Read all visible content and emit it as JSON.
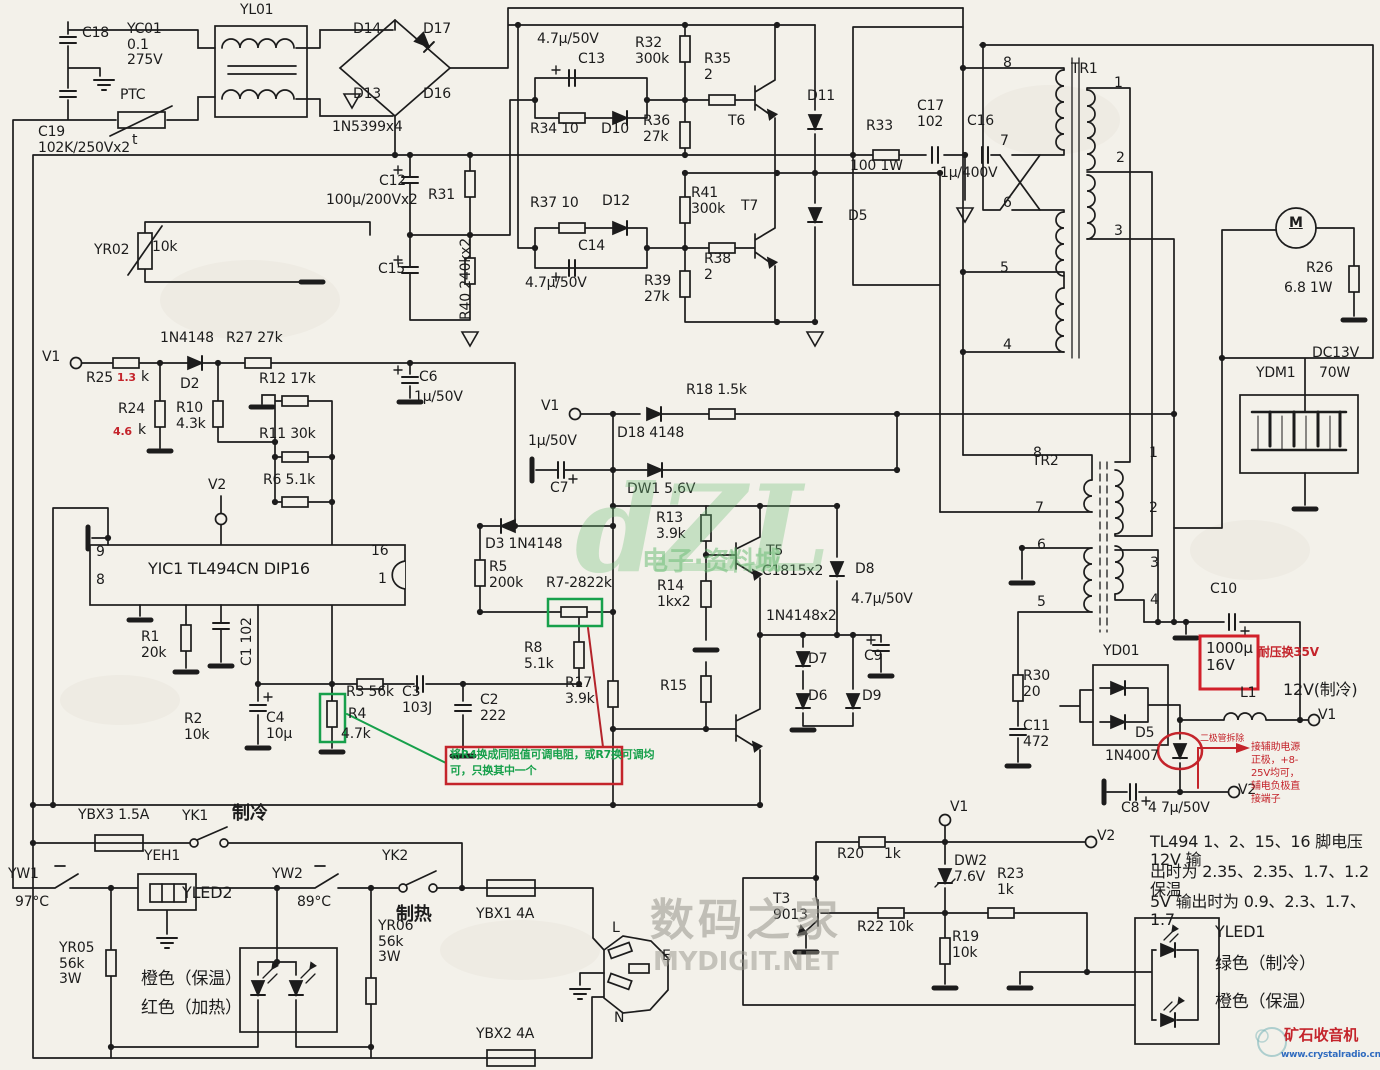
{
  "colors": {
    "paper": "#f3f1ea",
    "ink": "#1c1c1c",
    "red": "#c4242b",
    "green": "#17a04b",
    "blue": "#2f6bbf"
  },
  "labels": [
    {
      "n": "cap-c18",
      "t": "C18",
      "x": 82,
      "y": 26
    },
    {
      "n": "cap-yc01",
      "t": "YC01\n0.1\n275V",
      "x": 127,
      "y": 22
    },
    {
      "n": "ptc",
      "t": "PTC",
      "x": 120,
      "y": 88
    },
    {
      "n": "ptc-t",
      "t": "t",
      "x": 132,
      "y": 133
    },
    {
      "n": "cap-c19",
      "t": "C19\n102K/250Vx2",
      "x": 38,
      "y": 125
    },
    {
      "n": "choke-yl01",
      "t": "YL01",
      "x": 240,
      "y": 3
    },
    {
      "n": "diode-d14",
      "t": "D14",
      "x": 353,
      "y": 22
    },
    {
      "n": "diode-d17",
      "t": "D17",
      "x": 423,
      "y": 22
    },
    {
      "n": "diode-d13",
      "t": "D13",
      "x": 353,
      "y": 87
    },
    {
      "n": "diode-d16",
      "t": "D16",
      "x": 423,
      "y": 87
    },
    {
      "n": "bridge-type",
      "t": "1N5399x4",
      "x": 332,
      "y": 120
    },
    {
      "n": "thermistor-yr02",
      "t": "YR02",
      "x": 94,
      "y": 243
    },
    {
      "n": "thermistor-yr02-val",
      "t": "10k",
      "x": 152,
      "y": 240
    },
    {
      "n": "cap-c12",
      "t": "C12",
      "x": 379,
      "y": 174
    },
    {
      "n": "cap-c12-val",
      "t": "100µ/200Vx2",
      "x": 326,
      "y": 193
    },
    {
      "n": "res-r31",
      "t": "R31",
      "x": 428,
      "y": 188
    },
    {
      "n": "cap-c15",
      "t": "C15",
      "x": 378,
      "y": 262
    },
    {
      "n": "res-r40",
      "t": "R40  240kx2",
      "x": 459,
      "y": 320,
      "c": "vert"
    },
    {
      "n": "diode-d2-type",
      "t": "1N4148",
      "x": 160,
      "y": 331
    },
    {
      "n": "res-r27",
      "t": "R27  27k",
      "x": 226,
      "y": 331
    },
    {
      "n": "term-v1-left",
      "t": "V1",
      "x": 42,
      "y": 350
    },
    {
      "n": "res-r25",
      "t": "R25",
      "x": 86,
      "y": 371
    },
    {
      "n": "res-r25-val",
      "t": "1.3",
      "x": 117,
      "y": 372,
      "c": "red hs"
    },
    {
      "n": "res-r25-k",
      "t": "k",
      "x": 141,
      "y": 370
    },
    {
      "n": "diode-d2",
      "t": "D2",
      "x": 180,
      "y": 377
    },
    {
      "n": "res-r24",
      "t": "R24",
      "x": 118,
      "y": 402
    },
    {
      "n": "res-r24-val",
      "t": "4.6",
      "x": 113,
      "y": 426,
      "c": "red hs"
    },
    {
      "n": "res-r24-k",
      "t": "k",
      "x": 138,
      "y": 423
    },
    {
      "n": "res-r10",
      "t": "R10\n4.3k",
      "x": 176,
      "y": 401
    },
    {
      "n": "res-r12",
      "t": "R12  17k",
      "x": 259,
      "y": 372
    },
    {
      "n": "res-r11",
      "t": "R11  30k",
      "x": 259,
      "y": 427
    },
    {
      "n": "res-r6",
      "t": "R6  5.1k",
      "x": 263,
      "y": 473
    },
    {
      "n": "term-v2-left",
      "t": "V2",
      "x": 208,
      "y": 478
    },
    {
      "n": "cap-c6",
      "t": "C6",
      "x": 419,
      "y": 370
    },
    {
      "n": "cap-c6-val",
      "t": "1µ/50V",
      "x": 414,
      "y": 390
    },
    {
      "n": "ic-pin9",
      "t": "9",
      "x": 96,
      "y": 545
    },
    {
      "n": "ic-pin8",
      "t": "8",
      "x": 96,
      "y": 573
    },
    {
      "n": "ic-yic1",
      "t": "YIC1  TL494CN  DIP16",
      "x": 148,
      "y": 560,
      "s": 16
    },
    {
      "n": "ic-pin16",
      "t": "16",
      "x": 371,
      "y": 544
    },
    {
      "n": "ic-pin1",
      "t": "1",
      "x": 378,
      "y": 572
    },
    {
      "n": "res-r1",
      "t": "R1\n20k",
      "x": 141,
      "y": 630
    },
    {
      "n": "cap-c1",
      "t": "C1  102",
      "x": 240,
      "y": 666,
      "c": "vert"
    },
    {
      "n": "res-r2",
      "t": "R2\n10k",
      "x": 184,
      "y": 712
    },
    {
      "n": "cap-c4",
      "t": "C4\n10µ",
      "x": 266,
      "y": 711
    },
    {
      "n": "res-r3",
      "t": "R3  56k",
      "x": 346,
      "y": 685
    },
    {
      "n": "res-r4",
      "t": "R4",
      "x": 348,
      "y": 707
    },
    {
      "n": "res-r4-val",
      "t": "4.7k",
      "x": 341,
      "y": 727
    },
    {
      "n": "cap-c3",
      "t": "C3\n103J",
      "x": 402,
      "y": 685
    },
    {
      "n": "cap-c2",
      "t": "C2\n222",
      "x": 480,
      "y": 693
    },
    {
      "n": "res-r8",
      "t": "R8\n5.1k",
      "x": 524,
      "y": 641
    },
    {
      "n": "res-r17",
      "t": "R17\n3.9k",
      "x": 565,
      "y": 676
    },
    {
      "n": "res-r5",
      "t": "R5\n200k",
      "x": 489,
      "y": 560
    },
    {
      "n": "diode-d3",
      "t": "D3  1N4148",
      "x": 485,
      "y": 537
    },
    {
      "n": "res-r7",
      "t": "R7-2822k",
      "x": 546,
      "y": 576
    },
    {
      "n": "term-v1-mid",
      "t": "V1",
      "x": 541,
      "y": 399
    },
    {
      "n": "diode-d18",
      "t": "D18  4148",
      "x": 617,
      "y": 426
    },
    {
      "n": "res-r18",
      "t": "R18  1.5k",
      "x": 686,
      "y": 383
    },
    {
      "n": "cap-c7-val",
      "t": "1µ/50V",
      "x": 528,
      "y": 434
    },
    {
      "n": "cap-c7",
      "t": "C7",
      "x": 550,
      "y": 481
    },
    {
      "n": "zener-dw1",
      "t": "DW1  5.6V",
      "x": 627,
      "y": 482
    },
    {
      "n": "res-r13",
      "t": "R13\n3.9k",
      "x": 656,
      "y": 511
    },
    {
      "n": "transistor-t5",
      "t": "T5",
      "x": 766,
      "y": 544
    },
    {
      "n": "transistor-t5-type",
      "t": "C1815x2",
      "x": 762,
      "y": 564
    },
    {
      "n": "res-r14",
      "t": "R14\n1kx2",
      "x": 657,
      "y": 579
    },
    {
      "n": "res-r15",
      "t": "R15",
      "x": 660,
      "y": 679
    },
    {
      "n": "diode-pair-type",
      "t": "1N4148x2",
      "x": 766,
      "y": 609
    },
    {
      "n": "diode-d7",
      "t": "D7",
      "x": 808,
      "y": 652
    },
    {
      "n": "diode-d6",
      "t": "D6",
      "x": 808,
      "y": 689
    },
    {
      "n": "diode-d9",
      "t": "D9",
      "x": 862,
      "y": 689
    },
    {
      "n": "cap-c9-val",
      "t": "4.7µ/50V",
      "x": 851,
      "y": 592
    },
    {
      "n": "cap-c9",
      "t": "C9",
      "x": 864,
      "y": 649
    },
    {
      "n": "diode-d8",
      "t": "D8",
      "x": 855,
      "y": 562
    },
    {
      "n": "cap-c13-val",
      "t": "4.7µ/50V",
      "x": 537,
      "y": 32
    },
    {
      "n": "cap-c13",
      "t": "C13",
      "x": 578,
      "y": 52
    },
    {
      "n": "res-r34",
      "t": "R34  10",
      "x": 530,
      "y": 122
    },
    {
      "n": "diode-d10",
      "t": "D10",
      "x": 601,
      "y": 122
    },
    {
      "n": "res-r32",
      "t": "R32\n300k",
      "x": 635,
      "y": 36
    },
    {
      "n": "res-r36",
      "t": "R36\n27k",
      "x": 643,
      "y": 114
    },
    {
      "n": "res-r35",
      "t": "R35\n2",
      "x": 704,
      "y": 52
    },
    {
      "n": "transistor-t6",
      "t": "T6",
      "x": 728,
      "y": 114
    },
    {
      "n": "diode-d11",
      "t": "D11",
      "x": 807,
      "y": 89
    },
    {
      "n": "res-r37",
      "t": "R37  10",
      "x": 530,
      "y": 196
    },
    {
      "n": "diode-d12",
      "t": "D12",
      "x": 602,
      "y": 194
    },
    {
      "n": "cap-c14",
      "t": "C14",
      "x": 578,
      "y": 239
    },
    {
      "n": "cap-c14-val",
      "t": "4.7µ/50V",
      "x": 525,
      "y": 276
    },
    {
      "n": "res-r41",
      "t": "R41\n300k",
      "x": 691,
      "y": 186
    },
    {
      "n": "transistor-t7",
      "t": "T7",
      "x": 741,
      "y": 199
    },
    {
      "n": "res-r38",
      "t": "R38\n2",
      "x": 704,
      "y": 252
    },
    {
      "n": "res-r39",
      "t": "R39\n27k",
      "x": 644,
      "y": 274
    },
    {
      "n": "diode-d5-top",
      "t": "D5",
      "x": 848,
      "y": 209
    },
    {
      "n": "res-r33",
      "t": "R33",
      "x": 866,
      "y": 119
    },
    {
      "n": "res-r33-val",
      "t": "100  1W",
      "x": 850,
      "y": 159
    },
    {
      "n": "cap-c17",
      "t": "C17\n102",
      "x": 917,
      "y": 99
    },
    {
      "n": "cap-c16",
      "t": "C16",
      "x": 967,
      "y": 114
    },
    {
      "n": "cap-c16-val",
      "t": "1µ/400V",
      "x": 940,
      "y": 166
    },
    {
      "n": "transformer-tr1",
      "t": "TR1",
      "x": 1071,
      "y": 62
    },
    {
      "n": "tr1-pin8",
      "t": "8",
      "x": 1003,
      "y": 56
    },
    {
      "n": "tr1-pin7",
      "t": "7",
      "x": 1000,
      "y": 134
    },
    {
      "n": "tr1-pin6",
      "t": "6",
      "x": 1003,
      "y": 196
    },
    {
      "n": "tr1-pin5",
      "t": "5",
      "x": 1000,
      "y": 261
    },
    {
      "n": "tr1-pin4",
      "t": "4",
      "x": 1003,
      "y": 338
    },
    {
      "n": "tr1-pin1",
      "t": "1",
      "x": 1114,
      "y": 76
    },
    {
      "n": "tr1-pin2",
      "t": "2",
      "x": 1116,
      "y": 151
    },
    {
      "n": "tr1-pin3",
      "t": "3",
      "x": 1114,
      "y": 224
    },
    {
      "n": "motor-m",
      "t": "M",
      "x": 1289,
      "y": 216,
      "c": "mm"
    },
    {
      "n": "res-r26",
      "t": "R26",
      "x": 1306,
      "y": 261
    },
    {
      "n": "res-r26-val",
      "t": "6.8  1W",
      "x": 1284,
      "y": 281
    },
    {
      "n": "peltier-volt",
      "t": "DC13V",
      "x": 1312,
      "y": 346
    },
    {
      "n": "peltier-watt",
      "t": "70W",
      "x": 1319,
      "y": 366
    },
    {
      "n": "peltier-ydm1",
      "t": "YDM1",
      "x": 1256,
      "y": 366
    },
    {
      "n": "transformer-tr2",
      "t": "TR2",
      "x": 1032,
      "y": 454
    },
    {
      "n": "tr2-pin8",
      "t": "8",
      "x": 1033,
      "y": 446
    },
    {
      "n": "tr2-pin7",
      "t": "7",
      "x": 1035,
      "y": 501
    },
    {
      "n": "tr2-pin6",
      "t": "6",
      "x": 1037,
      "y": 538
    },
    {
      "n": "tr2-pin5",
      "t": "5",
      "x": 1037,
      "y": 595
    },
    {
      "n": "tr2-pin1",
      "t": "1",
      "x": 1149,
      "y": 446
    },
    {
      "n": "tr2-pin2",
      "t": "2",
      "x": 1149,
      "y": 501
    },
    {
      "n": "tr2-pin3",
      "t": "3",
      "x": 1150,
      "y": 556
    },
    {
      "n": "tr2-pin4",
      "t": "4",
      "x": 1150,
      "y": 593
    },
    {
      "n": "cap-c10",
      "t": "C10",
      "x": 1210,
      "y": 582
    },
    {
      "n": "cap-1000u",
      "t": "1000µ\n16V",
      "x": 1206,
      "y": 640,
      "s": 15
    },
    {
      "n": "note-35v",
      "t": "耐压换35V",
      "x": 1258,
      "y": 646,
      "c": "red b",
      "s": 12
    },
    {
      "n": "inductor-l1",
      "t": "L1",
      "x": 1240,
      "y": 686
    },
    {
      "n": "out-12v",
      "t": "12V(制冷)",
      "x": 1283,
      "y": 681,
      "s": 16
    },
    {
      "n": "term-v1-out",
      "t": "V1",
      "x": 1318,
      "y": 708
    },
    {
      "n": "rect-yd01",
      "t": "YD01",
      "x": 1103,
      "y": 644
    },
    {
      "n": "res-r30",
      "t": "R30\n20",
      "x": 1023,
      "y": 669
    },
    {
      "n": "cap-c11",
      "t": "C11\n472",
      "x": 1023,
      "y": 719
    },
    {
      "n": "diode-d5-bot",
      "t": "D5",
      "x": 1135,
      "y": 726
    },
    {
      "n": "diode-d5-type",
      "t": "1N4007",
      "x": 1105,
      "y": 749
    },
    {
      "n": "note-diode-removed",
      "t": "二极管拆除",
      "x": 1200,
      "y": 734,
      "c": "red",
      "s": 9
    },
    {
      "n": "cap-c8",
      "t": "C8",
      "x": 1121,
      "y": 801
    },
    {
      "n": "cap-c8-val",
      "t": "4 7µ/50V",
      "x": 1148,
      "y": 801
    },
    {
      "n": "term-v2-out",
      "t": "V2",
      "x": 1238,
      "y": 783
    },
    {
      "n": "note-aux-1",
      "t": "接辅助电源",
      "x": 1251,
      "y": 742,
      "c": "red",
      "s": 10
    },
    {
      "n": "note-aux-2",
      "t": "正极，+8-",
      "x": 1251,
      "y": 755,
      "c": "red",
      "s": 10
    },
    {
      "n": "note-aux-3",
      "t": "25V均可，",
      "x": 1251,
      "y": 768,
      "c": "red",
      "s": 10
    },
    {
      "n": "note-aux-4",
      "t": "辅电负极直",
      "x": 1251,
      "y": 781,
      "c": "red",
      "s": 10
    },
    {
      "n": "note-aux-5",
      "t": "接端子",
      "x": 1251,
      "y": 794,
      "c": "red",
      "s": 10
    },
    {
      "n": "note-tl494-1",
      "t": "TL494  1、2、15、16 脚电压 12V 输",
      "x": 1150,
      "y": 833,
      "s": 16
    },
    {
      "n": "note-tl494-2",
      "t": "出时为 2.35、2.35、1.7、1.2  保温",
      "x": 1150,
      "y": 863,
      "s": 16
    },
    {
      "n": "note-tl494-3",
      "t": "5V 输出时为 0.9、2.3、1.7、1.7",
      "x": 1150,
      "y": 893,
      "s": 16
    },
    {
      "n": "led-yled1",
      "t": "YLED1",
      "x": 1215,
      "y": 923,
      "s": 16
    },
    {
      "n": "led-yled1-green",
      "t": "绿色（制冷）",
      "x": 1215,
      "y": 955,
      "s": 17
    },
    {
      "n": "led-yled1-orange",
      "t": "橙色（保温）",
      "x": 1215,
      "y": 993,
      "s": 17
    },
    {
      "n": "logo-crystalradio",
      "t": "矿石收音机",
      "x": 1284,
      "y": 1027,
      "c": "red b",
      "s": 15
    },
    {
      "n": "logo-crystalradio-url",
      "t": "www.crystalradio.cn",
      "x": 1281,
      "y": 1050,
      "c": "blue b",
      "s": 9
    },
    {
      "n": "fuse-ybx3",
      "t": "YBX3  1.5A",
      "x": 78,
      "y": 808
    },
    {
      "n": "switch-yk1",
      "t": "YK1",
      "x": 182,
      "y": 809
    },
    {
      "n": "mode-cool",
      "t": "制冷",
      "x": 232,
      "y": 804,
      "c": "b",
      "s": 18
    },
    {
      "n": "thermo-yw1",
      "t": "YW1",
      "x": 8,
      "y": 867
    },
    {
      "n": "thermo-yw1-val",
      "t": "97°C",
      "x": 15,
      "y": 895
    },
    {
      "n": "heater-yeh1",
      "t": "YEH1",
      "x": 144,
      "y": 849
    },
    {
      "n": "thermo-yw2",
      "t": "YW2",
      "x": 272,
      "y": 867
    },
    {
      "n": "thermo-yw2-val",
      "t": "89°C",
      "x": 297,
      "y": 895
    },
    {
      "n": "switch-yk2",
      "t": "YK2",
      "x": 382,
      "y": 849
    },
    {
      "n": "mode-heat",
      "t": "制热",
      "x": 396,
      "y": 905,
      "c": "b",
      "s": 18
    },
    {
      "n": "led-yled2",
      "t": "YLED2",
      "x": 182,
      "y": 884,
      "s": 16
    },
    {
      "n": "led-yled2-orange",
      "t": "橙色（保温）",
      "x": 141,
      "y": 970,
      "s": 17
    },
    {
      "n": "led-yled2-red",
      "t": "红色（加热）",
      "x": 141,
      "y": 999,
      "s": 17
    },
    {
      "n": "res-yr05",
      "t": "YR05\n56k\n3W",
      "x": 59,
      "y": 941
    },
    {
      "n": "res-yr06",
      "t": "YR06\n56k\n3W",
      "x": 378,
      "y": 919
    },
    {
      "n": "fuse-ybx1",
      "t": "YBX1  4A",
      "x": 476,
      "y": 907
    },
    {
      "n": "plug-l",
      "t": "L",
      "x": 612,
      "y": 921
    },
    {
      "n": "plug-e",
      "t": "E",
      "x": 662,
      "y": 949
    },
    {
      "n": "plug-n",
      "t": "N",
      "x": 614,
      "y": 1011
    },
    {
      "n": "fuse-ybx2",
      "t": "YBX2  4A",
      "x": 476,
      "y": 1027
    },
    {
      "n": "transistor-t3",
      "t": "T3\n9013",
      "x": 773,
      "y": 892
    },
    {
      "n": "res-r20",
      "t": "R20",
      "x": 837,
      "y": 847
    },
    {
      "n": "res-r20-val",
      "t": "1k",
      "x": 884,
      "y": 847
    },
    {
      "n": "term-v1-bot",
      "t": "V1",
      "x": 950,
      "y": 800
    },
    {
      "n": "term-v2-bot",
      "t": "V2",
      "x": 1097,
      "y": 829
    },
    {
      "n": "zener-dw2",
      "t": "DW2\n7.6V",
      "x": 954,
      "y": 854
    },
    {
      "n": "res-r23",
      "t": "R23\n1k",
      "x": 997,
      "y": 867
    },
    {
      "n": "res-r22",
      "t": "R22  10k",
      "x": 857,
      "y": 920
    },
    {
      "n": "res-r19",
      "t": "R19\n10k",
      "x": 952,
      "y": 930
    },
    {
      "n": "note-r4-swap-1",
      "t": "将R4换成同阻值可调电阻，或R7换可调均",
      "x": 450,
      "y": 749,
      "c": "green",
      "s": 11
    },
    {
      "n": "note-r4-swap-2",
      "t": "可，只换其中一个",
      "x": 450,
      "y": 765,
      "c": "green",
      "s": 11
    },
    {
      "n": "watermark-dzl",
      "t": "dZL",
      "x": 575,
      "y": 470,
      "c": "wm"
    },
    {
      "n": "watermark-dzl-text",
      "t": "电子·资料城",
      "x": 642,
      "y": 548,
      "c": "wmt",
      "s": 26
    },
    {
      "n": "watermark-mydigit",
      "t": "数码之家",
      "x": 650,
      "y": 896,
      "c": "wmg",
      "s": 44
    },
    {
      "n": "watermark-mydigit-url",
      "t": "MYDIGIT.NET",
      "x": 653,
      "y": 948,
      "c": "wmg2",
      "s": 26
    }
  ]
}
